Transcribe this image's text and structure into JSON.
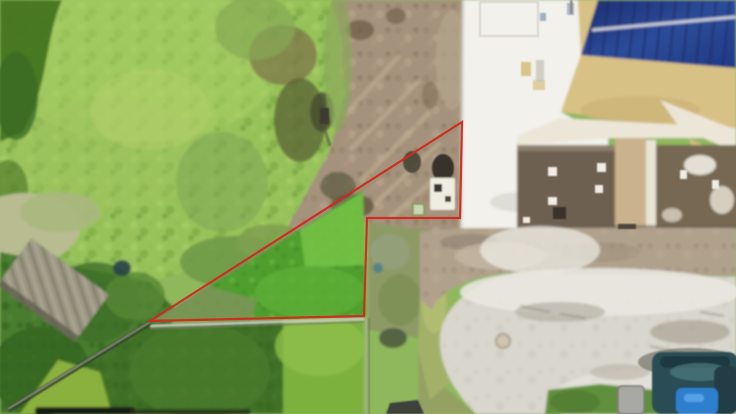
{
  "image": {
    "alt": "Aerial drone photo of a vacant land parcel outlined in red, bordered by a grassy hillside on the left and buildings with a cul-de-sac street on the right",
    "width": 736,
    "height": 414
  },
  "annotation": {
    "label": "parcel-boundary",
    "points": "462,122 460,218 367,218 364,316 150,321",
    "color": "#cf2a1e",
    "stroke_width": "2.2"
  },
  "palette": {
    "base_grass": "#8fb85c",
    "hill_grass": "#97c25a",
    "dark_foliage": "#4a7c2e",
    "lawn_dark": "#3f7026",
    "lawn_bright": "#7cb13e",
    "turf": "#4f9e2e",
    "dirt": "#a5927b",
    "white_roof": "#f2f1ec",
    "tan_roof": "#d8c185",
    "solar_panel": "#24397f",
    "brown_building": "#6e6051",
    "gravel": "#b0a18d",
    "road": "#d9d6cd"
  }
}
